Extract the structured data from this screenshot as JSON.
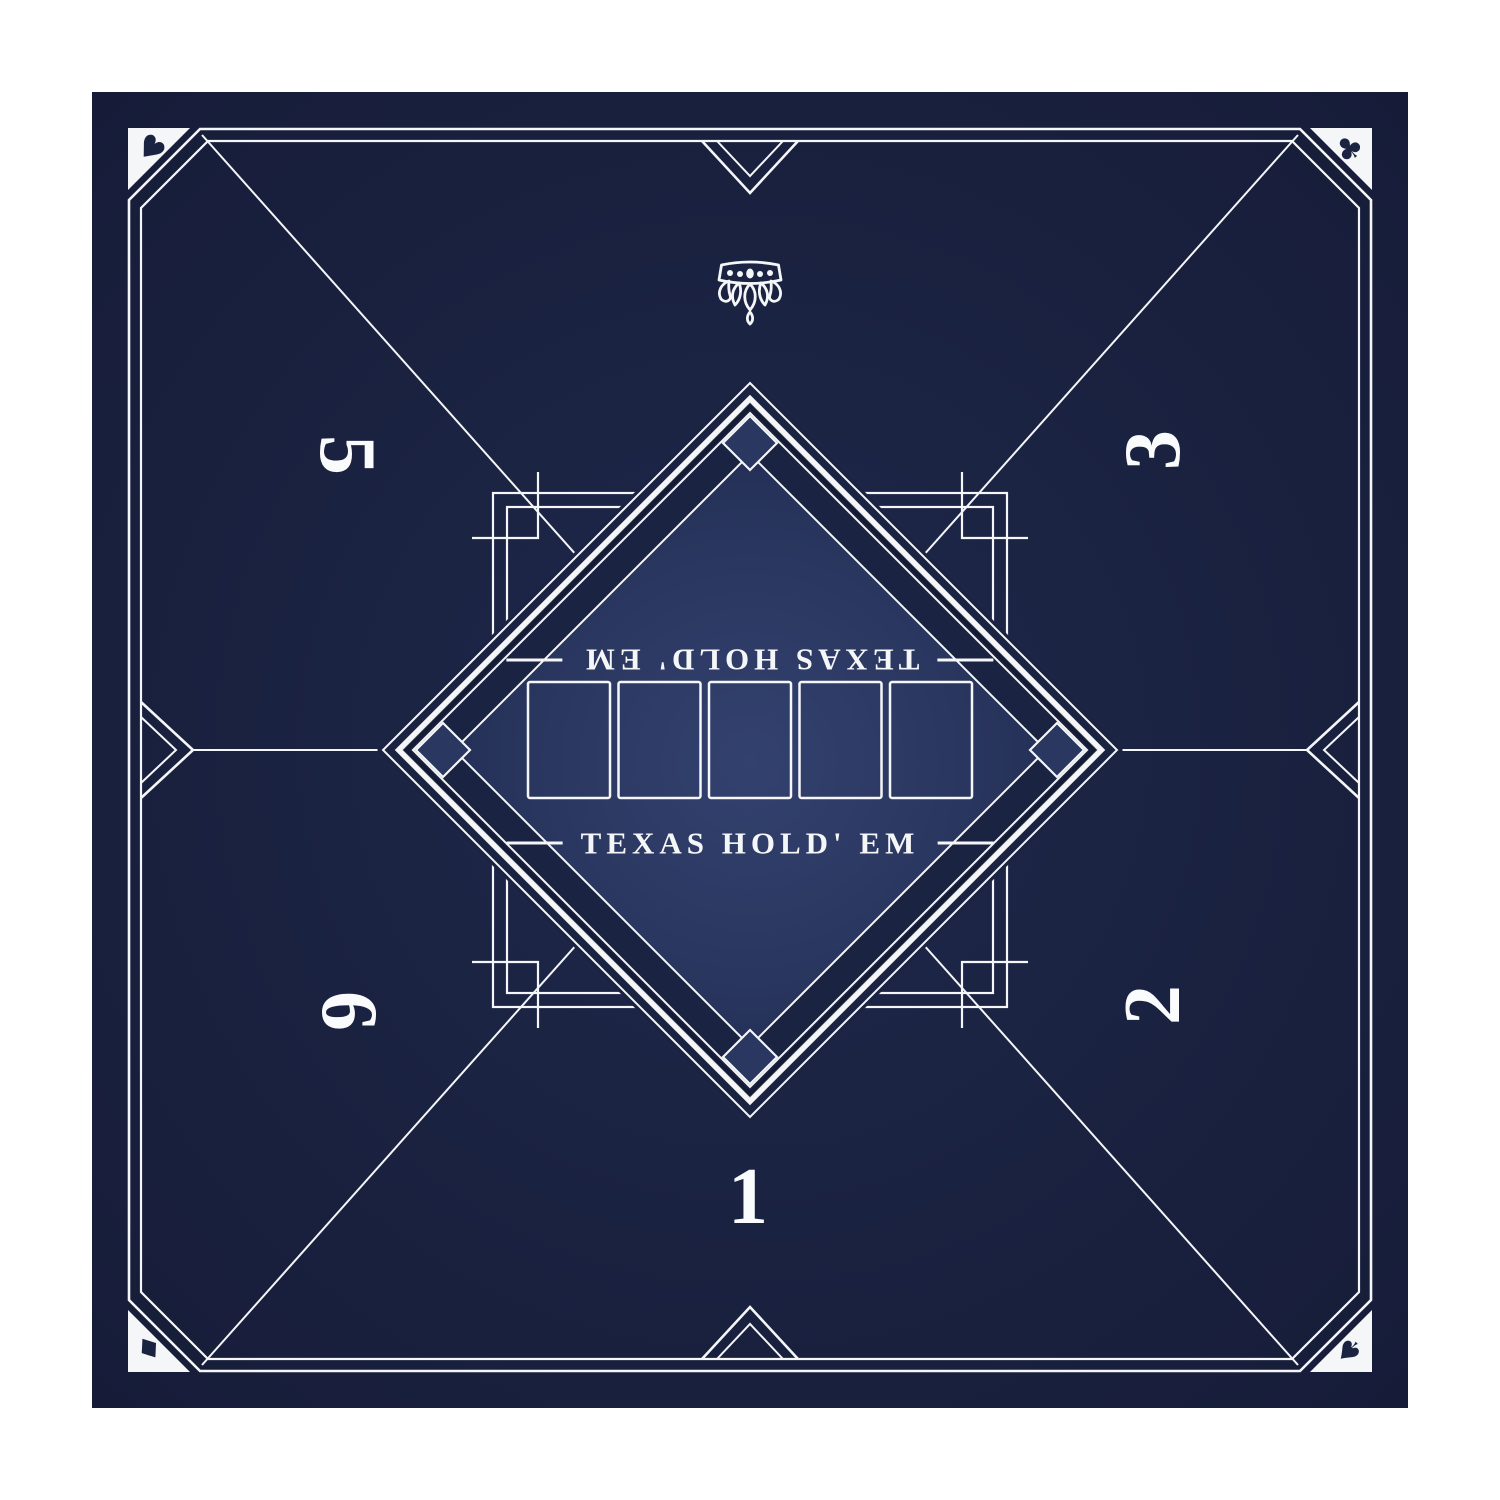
{
  "product": {
    "kind": "poker-table-mat",
    "title": "TEXAS HOLD' EM"
  },
  "titles": {
    "bottom": "TEXAS HOLD' EM",
    "top_rotated": "TEXAS HOLD' EM"
  },
  "seats": {
    "s1": {
      "label": "1"
    },
    "s2": {
      "label": "2"
    },
    "s3": {
      "label": "3"
    },
    "s5": {
      "label": "5"
    },
    "s6": {
      "label": "6"
    }
  },
  "corner_suits": {
    "top_left": {
      "name": "heart",
      "glyph": "♥"
    },
    "top_right": {
      "name": "club",
      "glyph": "♣"
    },
    "bottom_left": {
      "name": "diamond",
      "glyph": "♦"
    },
    "bottom_right": {
      "name": "spade",
      "glyph": "♠"
    }
  },
  "community_cards": {
    "slots": 5
  },
  "ornament": {
    "name": "crown-ornament"
  },
  "colors": {
    "mat_navy": "#1b2342",
    "mat_navy_dark": "#161c38",
    "center_panel_blue": "#2c3a66",
    "line_white": "#f5f6f8"
  }
}
